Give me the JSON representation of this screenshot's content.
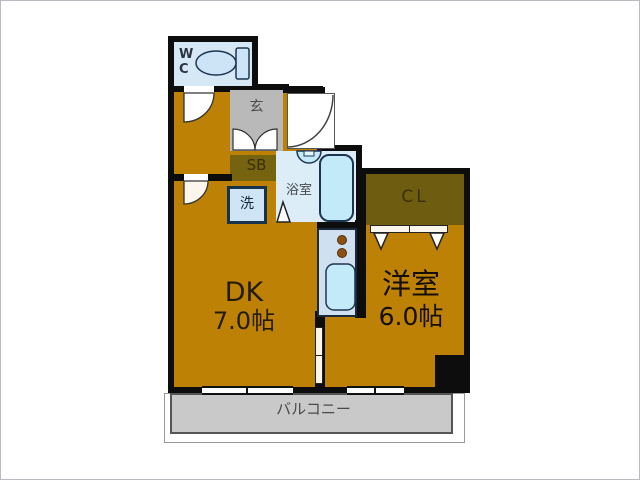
{
  "title": "apartment-floorplan",
  "rooms": {
    "wc": {
      "label": "WC"
    },
    "genkan": {
      "label": "玄"
    },
    "shoebox": {
      "label": "SB"
    },
    "bathroom": {
      "label": "浴室"
    },
    "laundry": {
      "label": "洗"
    },
    "closet": {
      "label": "CL"
    },
    "dk": {
      "label": "DK",
      "size": "7.0帖"
    },
    "western": {
      "label": "洋室",
      "size": "6.0帖"
    },
    "balcony": {
      "label": "バルコニー"
    }
  },
  "colors": {
    "room_brown": "#bd8106",
    "closet_olive": "#6e5d10",
    "shoebox_olive": "#75630f",
    "bath_blue": "#dcedf8",
    "wc_blue": "#d6e8f6",
    "genkan_gray": "#b9b9b9",
    "balcony_gray": "#c9c9c9",
    "fixture_blue": "#c3eaf9",
    "counter_blue": "#cfe0f1",
    "wall_black": "#0d0d0d"
  }
}
